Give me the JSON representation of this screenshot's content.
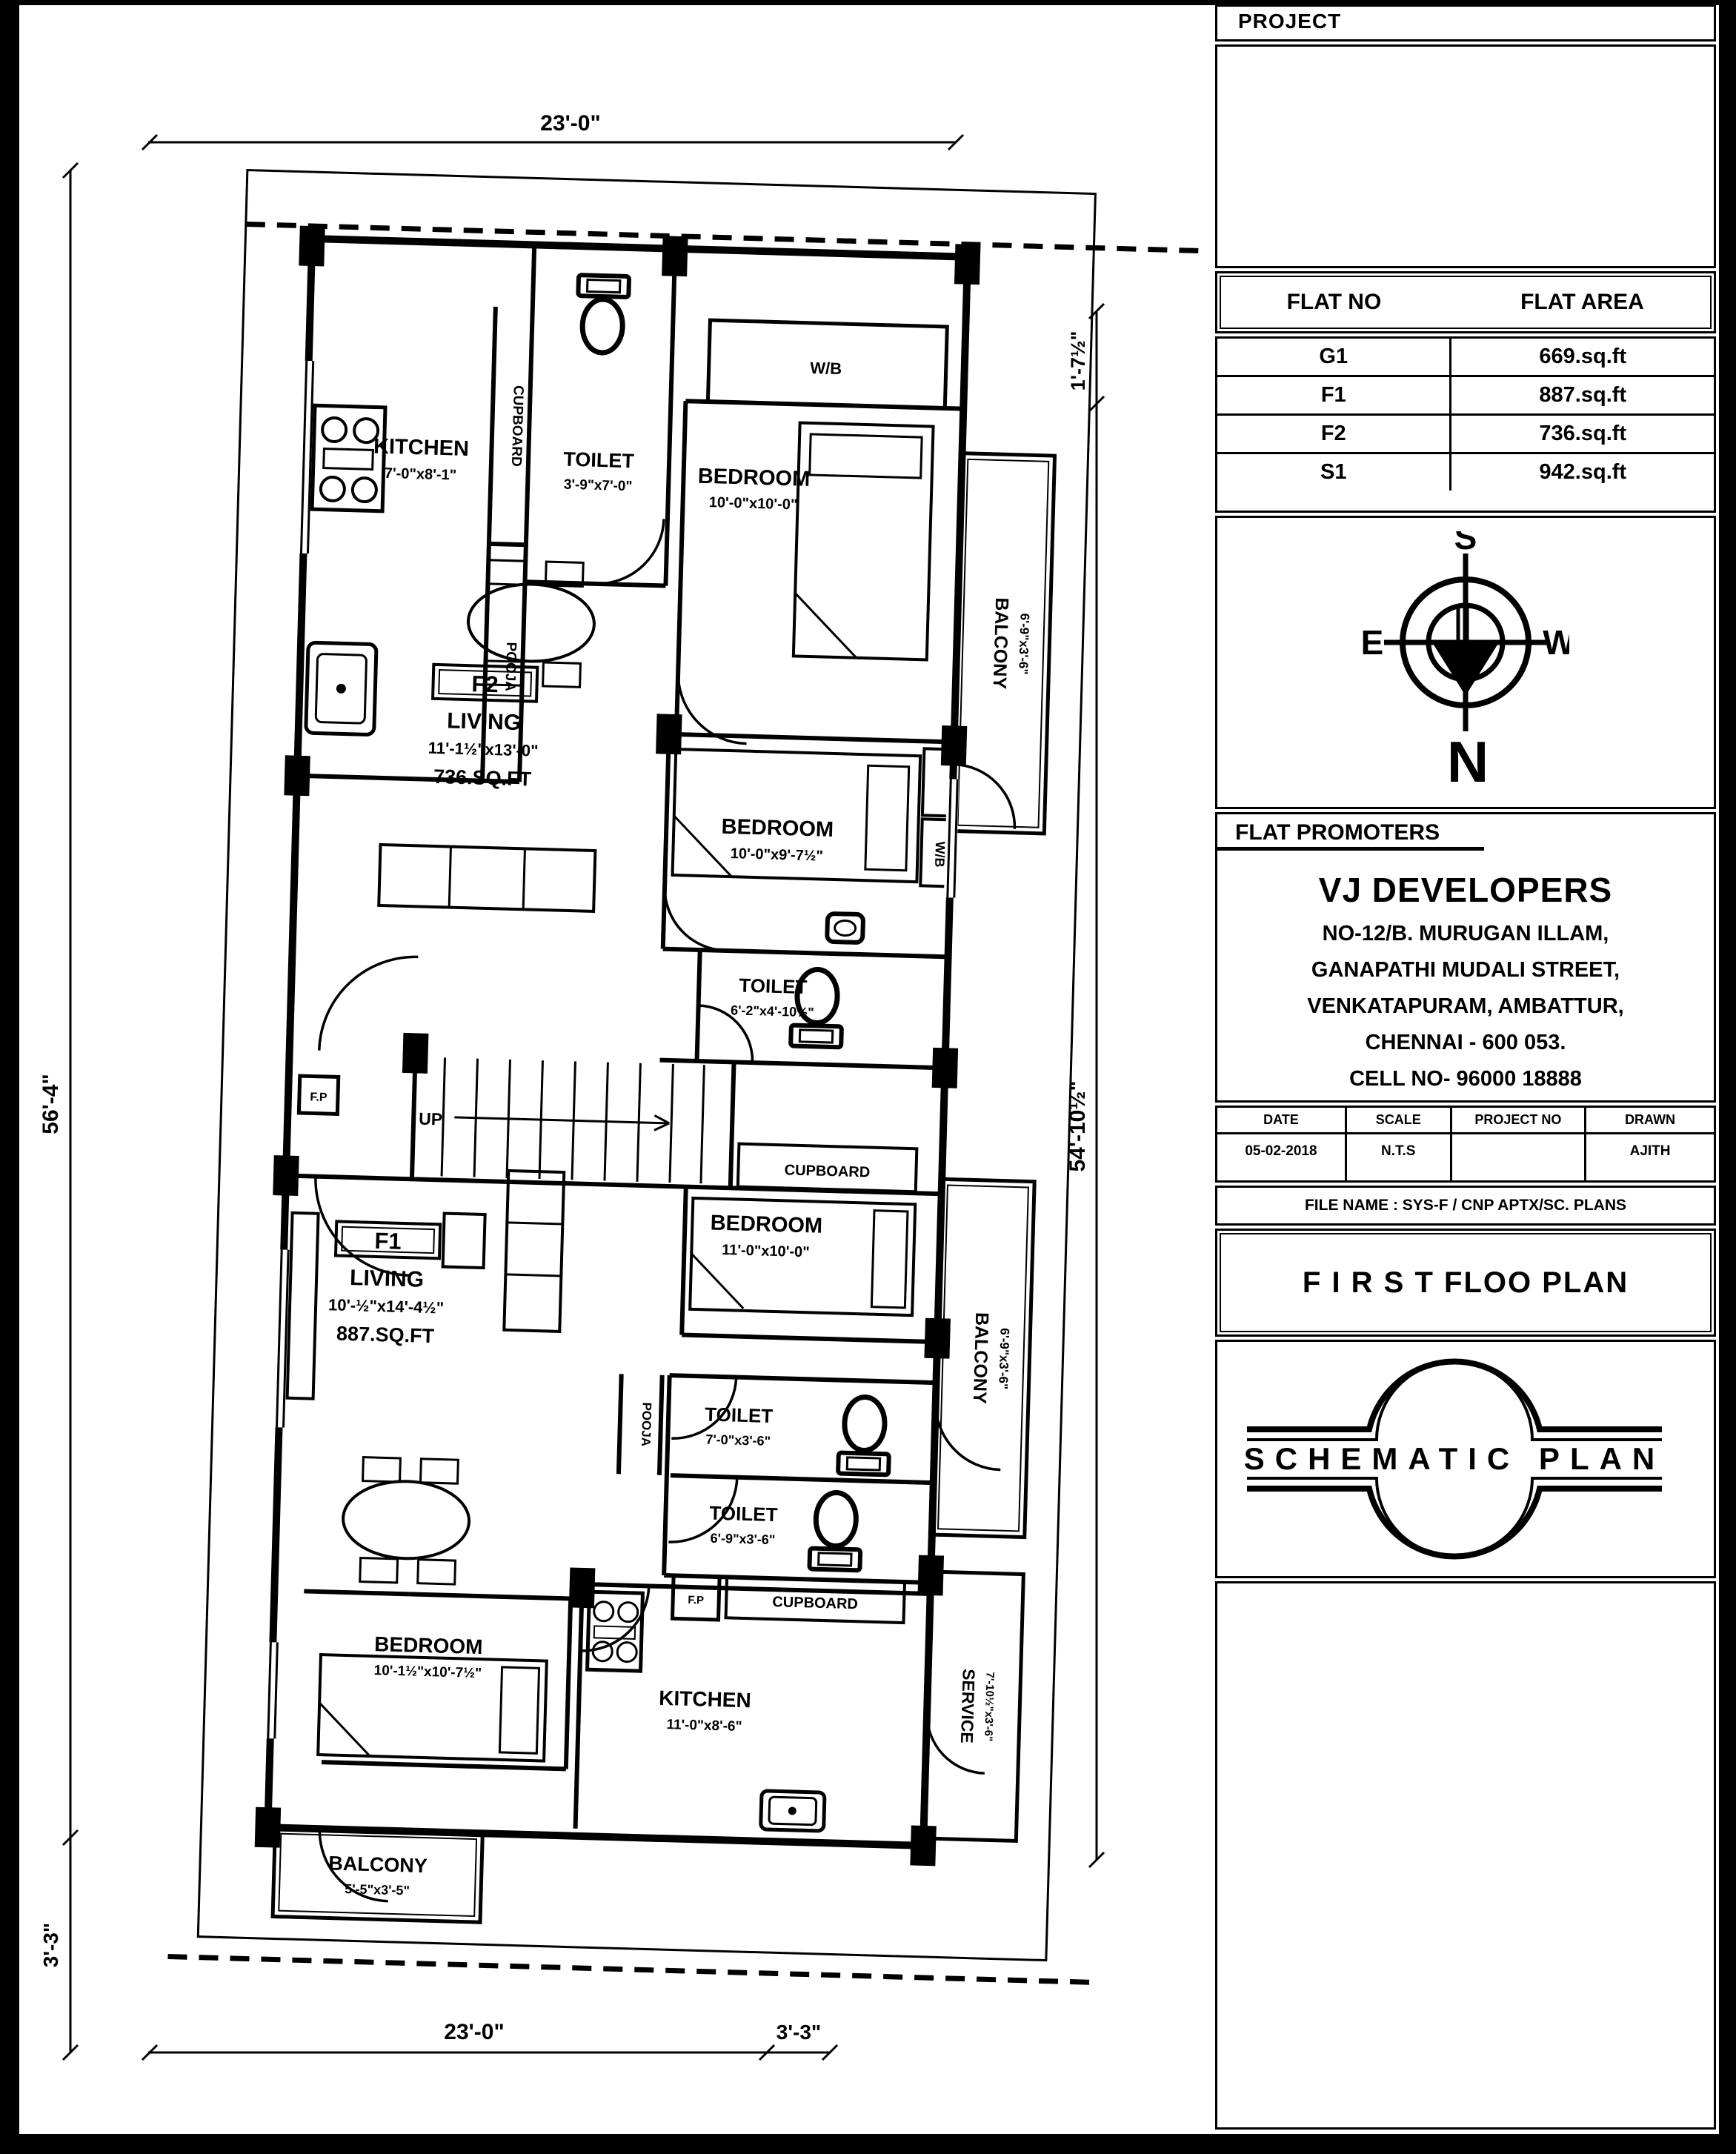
{
  "title_block": {
    "project_label": "PROJECT",
    "flat_table": {
      "col1": "FLAT NO",
      "col2": "FLAT AREA",
      "rows": [
        {
          "no": "G1",
          "area": "669.sq.ft"
        },
        {
          "no": "F1",
          "area": "887.sq.ft"
        },
        {
          "no": "F2",
          "area": "736.sq.ft"
        },
        {
          "no": "S1",
          "area": "942.sq.ft"
        }
      ]
    },
    "compass": {
      "top": "S",
      "bottom": "N",
      "left": "E",
      "right": "W"
    },
    "promoters": {
      "header": "FLAT  PROMOTERS",
      "name": "VJ DEVELOPERS",
      "line1": "NO-12/B. MURUGAN ILLAM,",
      "line2": "GANAPATHI MUDALI STREET,",
      "line3": "VENKATAPURAM, AMBATTUR,",
      "line4": "CHENNAI - 600 053.",
      "line5": "CELL NO- 96000 18888"
    },
    "meta": {
      "date_label": "DATE",
      "scale_label": "SCALE",
      "project_no_label": "PROJECT NO",
      "drawn_label": "DRAWN",
      "date": "05-02-2018",
      "scale": "N.T.S",
      "project_no": "",
      "drawn": "AJITH"
    },
    "file_name": "FILE NAME : SYS-F / CNP APTX/SC. PLANS",
    "drawing_title": "F I R S T FLOO PLAN",
    "stamp": "SCHEMATIC PLAN"
  },
  "plan": {
    "dims": {
      "top": "23'-0\"",
      "left_main": "56'-4\"",
      "left_bottom": "3'-3\"",
      "right_top": "1'-7½\"",
      "right_main": "54'-10½\"",
      "bottom_main": "23'-0\"",
      "bottom_right": "3'-3\""
    },
    "f2": {
      "flat_label": "F2",
      "kitchen": {
        "name": "KITCHEN",
        "dims": "7'-0\"x8'-1\""
      },
      "cupboard": "CUPBOARD",
      "pooja": "POOJA",
      "toilet_top": {
        "name": "TOILET",
        "dims": "3'-9\"x7'-0\""
      },
      "bedroom_top": {
        "name": "BEDROOM",
        "dims": "10'-0\"x10'-0\""
      },
      "wb_top": "W/B",
      "balcony": {
        "name": "BALCONY",
        "dims": "6'-9\"x3'-6\""
      },
      "living": {
        "name": "LIVING",
        "dims": "11'-1½\"x13'-0\"",
        "area": "736.SQ.FT"
      },
      "bedroom_mid": {
        "name": "BEDROOM",
        "dims": "10'-0\"x9'-7½\""
      },
      "toilet_mid": {
        "name": "TOILET",
        "dims": "6'-2\"x4'-10½\""
      },
      "wb_mid": "W/B",
      "cupboard_stair": "CUPBOARD",
      "up": "UP",
      "fp": "F.P"
    },
    "f1": {
      "flat_label": "F1",
      "living": {
        "name": "LIVING",
        "dims": "10'-½\"x14'-4½\"",
        "area": "887.SQ.FT"
      },
      "bedroom_top": {
        "name": "BEDROOM",
        "dims": "11'-0\"x10'-0\""
      },
      "balcony_right": {
        "name": "BALCONY",
        "dims": "6'-9\"x3'-6\""
      },
      "toilet_a": {
        "name": "TOILET",
        "dims": "7'-0\"x3'-6\""
      },
      "pooja": "POOJA",
      "toilet_b": {
        "name": "TOILET",
        "dims": "6'-9\"x3'-6\""
      },
      "cupboard": "CUPBOARD",
      "fp": "F.P",
      "bedroom_bottom": {
        "name": "BEDROOM",
        "dims": "10'-1½\"x10'-7½\""
      },
      "kitchen": {
        "name": "KITCHEN",
        "dims": "11'-0\"x8'-6\""
      },
      "service": {
        "name": "SERVICE",
        "dims": "7'-10½\"x3'-6\""
      },
      "balcony_bottom": {
        "name": "BALCONY",
        "dims": "5'-5\"x3'-5\""
      }
    }
  }
}
